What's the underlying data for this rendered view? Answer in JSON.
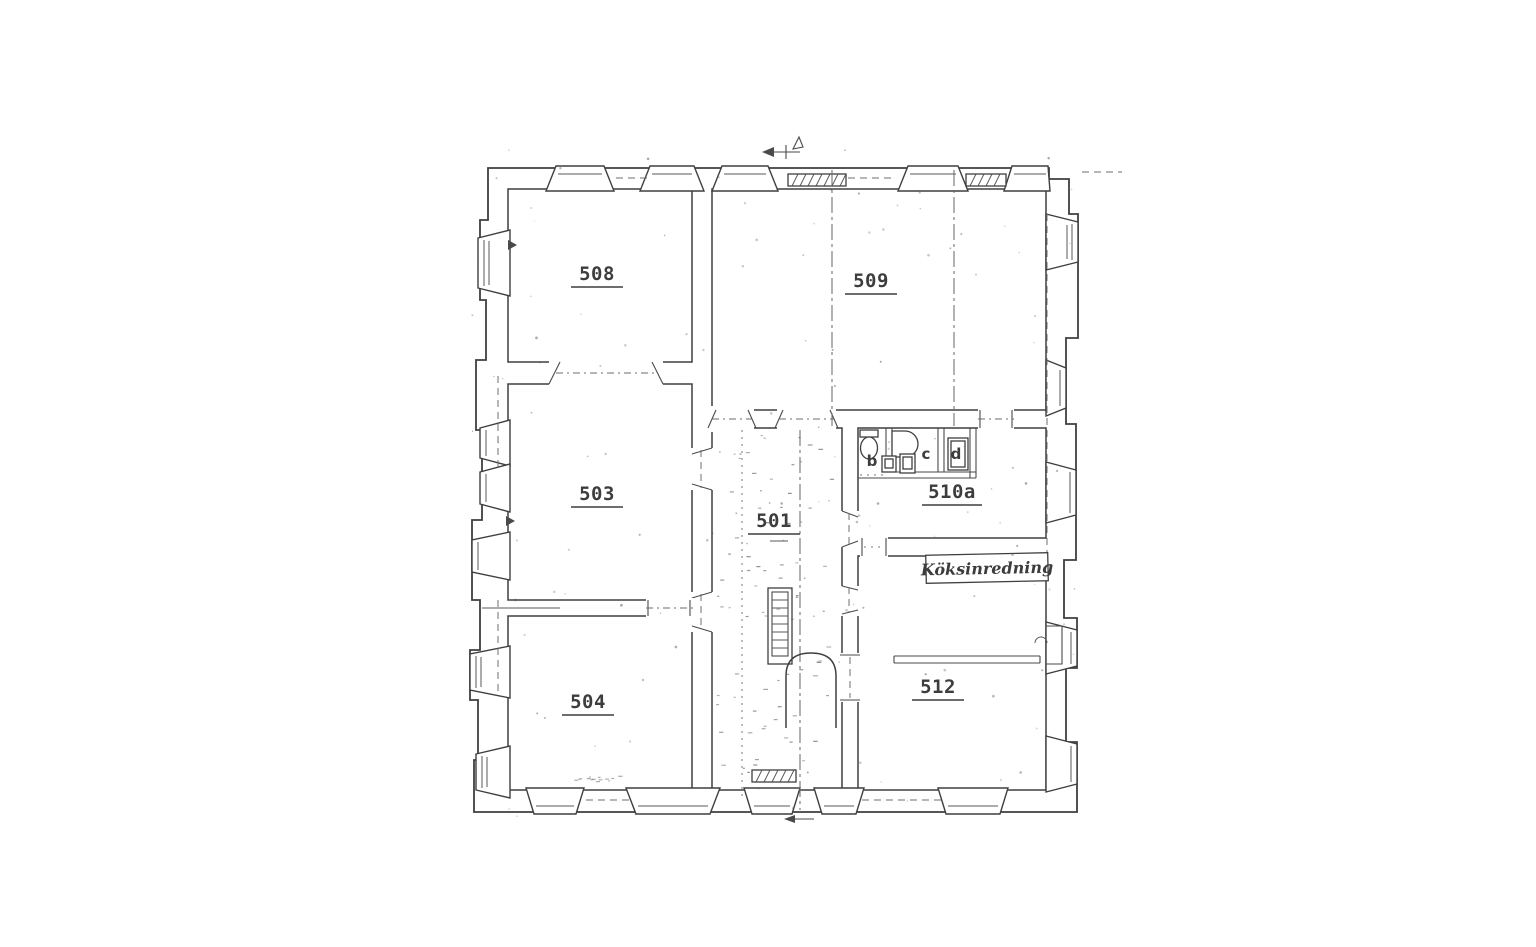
{
  "page": {
    "background": "#ffffff",
    "ink": "#3d3d3d",
    "ink_light": "#7a7a7a"
  },
  "plan": {
    "type": "scanned-architectural-floor-plan",
    "rooms": [
      {
        "id": "501",
        "label": "501"
      },
      {
        "id": "503",
        "label": "503"
      },
      {
        "id": "504",
        "label": "504"
      },
      {
        "id": "508",
        "label": "508"
      },
      {
        "id": "509",
        "label": "509"
      },
      {
        "id": "510a",
        "label": "510a"
      },
      {
        "id": "512",
        "label": "512"
      }
    ],
    "compartments": [
      {
        "id": "b",
        "label": "b"
      },
      {
        "id": "c",
        "label": "c"
      },
      {
        "id": "d",
        "label": "d"
      }
    ],
    "annotations": {
      "kitchen_note": "Köksinredning"
    }
  }
}
